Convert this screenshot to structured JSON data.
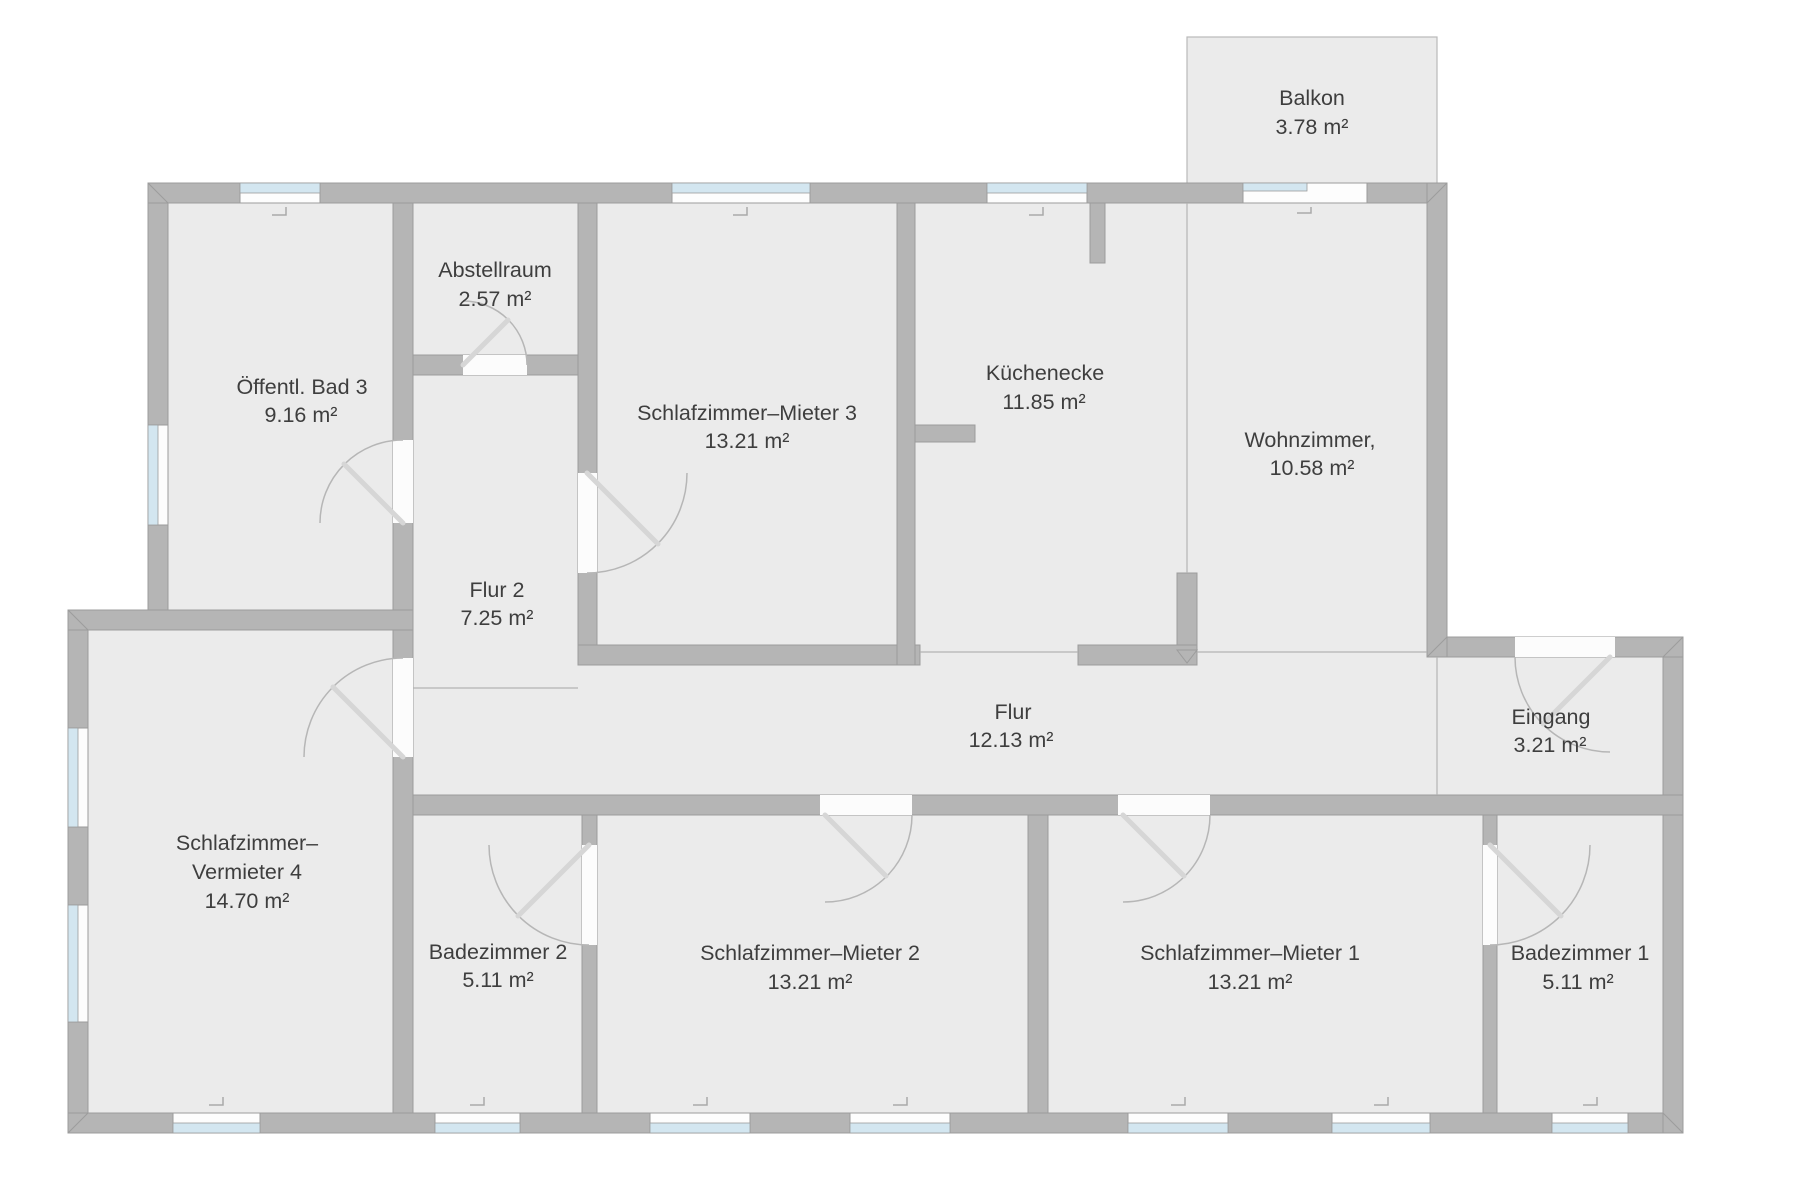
{
  "plan": {
    "type": "floor-plan",
    "language": "de",
    "colors": {
      "background": "#ffffff",
      "floor": "#ebebeb",
      "wall": "#b5b5b5",
      "wall_edge": "#9c9c9c",
      "window_glass": "#d3e6f0",
      "door_arc": "#b6b6b6",
      "text": "#3e3e3e"
    }
  },
  "rooms": [
    {
      "id": "balkon",
      "name": "Balkon",
      "area": "3.78 m²"
    },
    {
      "id": "oeffentl-bad-3",
      "name": "Öffentl. Bad 3",
      "area": "9.16 m²"
    },
    {
      "id": "abstellraum",
      "name": "Abstellraum",
      "area": "2.57 m²"
    },
    {
      "id": "schlafzimmer-mieter-3",
      "name": "Schlafzimmer–Mieter 3",
      "area": "13.21 m²"
    },
    {
      "id": "kuechenecke",
      "name": "Küchenecke",
      "area": "11.85 m²"
    },
    {
      "id": "wohnzimmer",
      "name": "Wohnzimmer,",
      "area": "10.58 m²"
    },
    {
      "id": "flur-2",
      "name": "Flur 2",
      "area": "7.25 m²"
    },
    {
      "id": "flur",
      "name": "Flur",
      "area": "12.13 m²"
    },
    {
      "id": "eingang",
      "name": "Eingang",
      "area": "3.21 m²"
    },
    {
      "id": "schlafzimmer-vermieter-4",
      "name_line1": "Schlafzimmer–",
      "name_line2": "Vermieter 4",
      "area": "14.70 m²"
    },
    {
      "id": "badezimmer-2",
      "name": "Badezimmer 2",
      "area": "5.11 m²"
    },
    {
      "id": "schlafzimmer-mieter-2",
      "name": "Schlafzimmer–Mieter 2",
      "area": "13.21 m²"
    },
    {
      "id": "schlafzimmer-mieter-1",
      "name": "Schlafzimmer–Mieter 1",
      "area": "13.21 m²"
    },
    {
      "id": "badezimmer-1",
      "name": "Badezimmer 1",
      "area": "5.11 m²"
    }
  ]
}
